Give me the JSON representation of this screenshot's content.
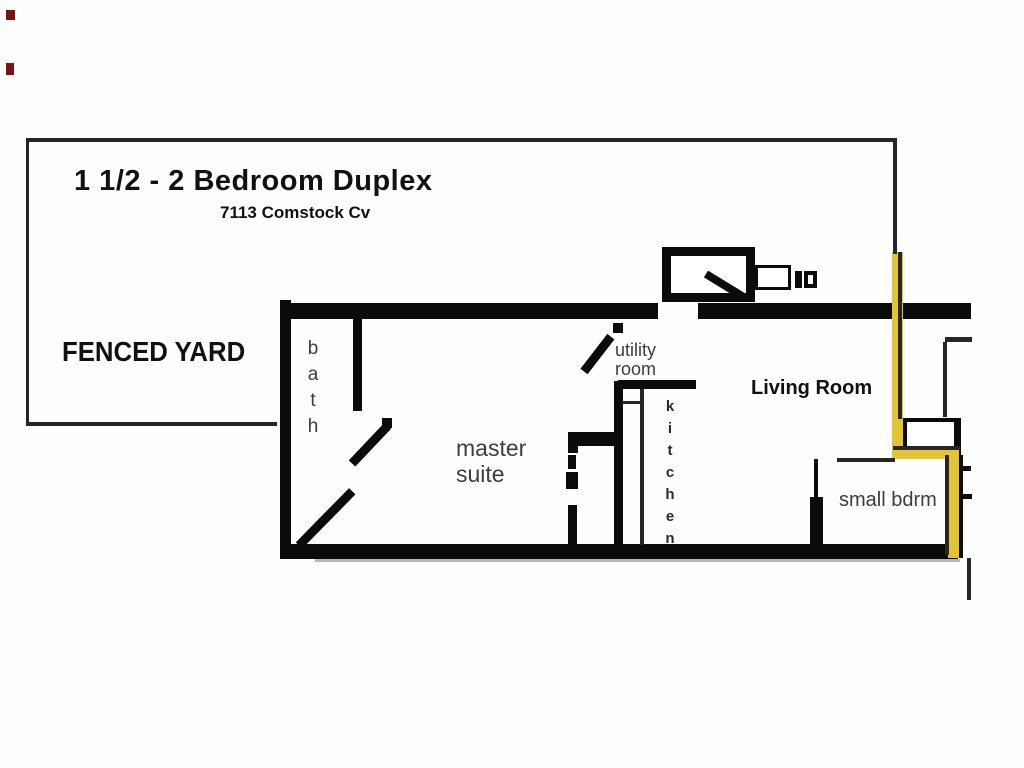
{
  "header": {
    "title": "1 1/2 - 2  Bedroom Duplex",
    "address": "7113 Comstock Cv"
  },
  "yard": {
    "label": "FENCED YARD"
  },
  "rooms": {
    "bath": "bath",
    "utility": "utility\nroom",
    "master": "master\nsuite",
    "kitchen": "kitchen",
    "living": "Living Room",
    "small_bdrm": "small bdrm"
  },
  "colors": {
    "wall": "#0b0b0b",
    "thin": "#262626",
    "yellow": "#e2c435",
    "label_gray": "#3d3d3d",
    "red_mark": "#7a1114",
    "shadow": "#b5b5b5"
  },
  "floorplan": {
    "walls": [
      {
        "name": "house-left-wall",
        "x": 280,
        "y": 300,
        "w": 11,
        "h": 258
      },
      {
        "name": "house-top-wall-left",
        "x": 280,
        "y": 303,
        "w": 378,
        "h": 16
      },
      {
        "name": "house-top-wall-right",
        "x": 698,
        "y": 303,
        "w": 273,
        "h": 16
      },
      {
        "name": "house-bottom-wall",
        "x": 280,
        "y": 544,
        "w": 678,
        "h": 15
      },
      {
        "name": "bath-divider-wall",
        "x": 353,
        "y": 319,
        "w": 9,
        "h": 92
      },
      {
        "name": "kitchen-west-wall",
        "x": 614,
        "y": 381,
        "w": 9,
        "h": 163
      },
      {
        "name": "utility-bottom-wall",
        "x": 618,
        "y": 380,
        "w": 78,
        "h": 9
      },
      {
        "name": "master-east-wall-bar",
        "x": 568,
        "y": 432,
        "w": 54,
        "h": 14
      },
      {
        "name": "master-east-wall-nub",
        "x": 568,
        "y": 432,
        "w": 10,
        "h": 21
      },
      {
        "name": "master-closet-dash-1",
        "x": 568,
        "y": 455,
        "w": 8,
        "h": 14
      },
      {
        "name": "master-closet-dash-2",
        "x": 566,
        "y": 472,
        "w": 12,
        "h": 17
      },
      {
        "name": "master-closet-solid",
        "x": 568,
        "y": 505,
        "w": 9,
        "h": 39
      },
      {
        "name": "bdrm-west-wall-thin",
        "x": 814,
        "y": 459,
        "w": 4,
        "h": 38
      },
      {
        "name": "bdrm-west-wall-thick",
        "x": 810,
        "y": 497,
        "w": 13,
        "h": 48
      },
      {
        "name": "storage-right-bar",
        "x": 951,
        "y": 418,
        "w": 10,
        "h": 54
      },
      {
        "name": "bdrm-right-wall",
        "x": 955,
        "y": 455,
        "w": 8,
        "h": 103
      },
      {
        "name": "right-tick-upper",
        "x": 962,
        "y": 466,
        "w": 9,
        "h": 5
      },
      {
        "name": "right-tick-lower",
        "x": 962,
        "y": 494,
        "w": 10,
        "h": 5
      },
      {
        "name": "utility-door-jamb",
        "x": 613,
        "y": 323,
        "w": 10,
        "h": 10
      },
      {
        "name": "bath-door-knob",
        "x": 382,
        "y": 418,
        "w": 10,
        "h": 10
      },
      {
        "name": "fireplace-vent-bar",
        "x": 795,
        "y": 271,
        "w": 7,
        "h": 17
      }
    ],
    "outlines": [
      {
        "name": "fireplace-box",
        "x": 662,
        "y": 247,
        "w": 93,
        "h": 55,
        "b": 9
      },
      {
        "name": "fireplace-hearth-box",
        "x": 755,
        "y": 265,
        "w": 36,
        "h": 25,
        "b": 3
      },
      {
        "name": "fireplace-vent-outline",
        "x": 804,
        "y": 271,
        "w": 13,
        "h": 17,
        "b": 4
      },
      {
        "name": "storage-box",
        "x": 903,
        "y": 418,
        "w": 55,
        "h": 34,
        "b": 4
      }
    ],
    "diagonals": [
      {
        "name": "bath-door-leaf",
        "x1": 352,
        "y1": 463,
        "x2": 388,
        "y2": 425,
        "t": 9
      },
      {
        "name": "master-door-leaf",
        "x1": 299,
        "y1": 545,
        "x2": 352,
        "y2": 491,
        "t": 9
      },
      {
        "name": "utility-door-leaf",
        "x1": 584,
        "y1": 371,
        "x2": 611,
        "y2": 336,
        "t": 9
      },
      {
        "name": "fireplace-diagonal",
        "x1": 706,
        "y1": 274,
        "x2": 742,
        "y2": 296,
        "t": 8
      }
    ],
    "yellow_segments": [
      {
        "name": "yellow-path-vertical-1",
        "x": 892,
        "y": 252,
        "w": 11,
        "h": 207
      },
      {
        "name": "yellow-path-horizontal",
        "x": 892,
        "y": 448,
        "w": 66,
        "h": 11
      },
      {
        "name": "yellow-path-vertical-2",
        "x": 948,
        "y": 448,
        "w": 11,
        "h": 110
      }
    ],
    "thin_lines": [
      {
        "name": "yard-top-edge",
        "x": 27,
        "y": 138,
        "w": 870,
        "h": 4
      },
      {
        "name": "yard-left-edge",
        "x": 26,
        "y": 138,
        "w": 3,
        "h": 288
      },
      {
        "name": "yard-bottom-edge",
        "x": 26,
        "y": 422,
        "w": 251,
        "h": 4
      },
      {
        "name": "yard-right-edge",
        "x": 893,
        "y": 140,
        "w": 4,
        "h": 114
      },
      {
        "name": "kitchen-counter-line",
        "x": 640,
        "y": 389,
        "w": 4,
        "h": 156
      },
      {
        "name": "kitchen-shelf-line",
        "x": 622,
        "y": 401,
        "w": 19,
        "h": 3
      },
      {
        "name": "bdrm-top-line",
        "x": 837,
        "y": 458,
        "w": 58,
        "h": 4
      },
      {
        "name": "window-line-horizontal",
        "x": 945,
        "y": 337,
        "w": 27,
        "h": 5
      },
      {
        "name": "window-line-vertical",
        "x": 943,
        "y": 342,
        "w": 4,
        "h": 75
      },
      {
        "name": "living-right-line",
        "x": 898,
        "y": 252,
        "w": 4,
        "h": 167
      },
      {
        "name": "yellow-h-top-line",
        "x": 893,
        "y": 446,
        "w": 67,
        "h": 4
      },
      {
        "name": "yellow-v2-left-line",
        "x": 945,
        "y": 455,
        "w": 4,
        "h": 100
      },
      {
        "name": "below-wall-stub-line",
        "x": 967,
        "y": 558,
        "w": 4,
        "h": 42
      }
    ],
    "marks": [
      {
        "name": "red-artifact-upper",
        "x": 6,
        "y": 10,
        "w": 9,
        "h": 10
      },
      {
        "name": "red-artifact-lower",
        "x": 6,
        "y": 63,
        "w": 8,
        "h": 12
      }
    ],
    "shadows": [
      {
        "name": "bottom-wall-shadow",
        "x": 315,
        "y": 559,
        "w": 645,
        "h": 3
      }
    ]
  }
}
